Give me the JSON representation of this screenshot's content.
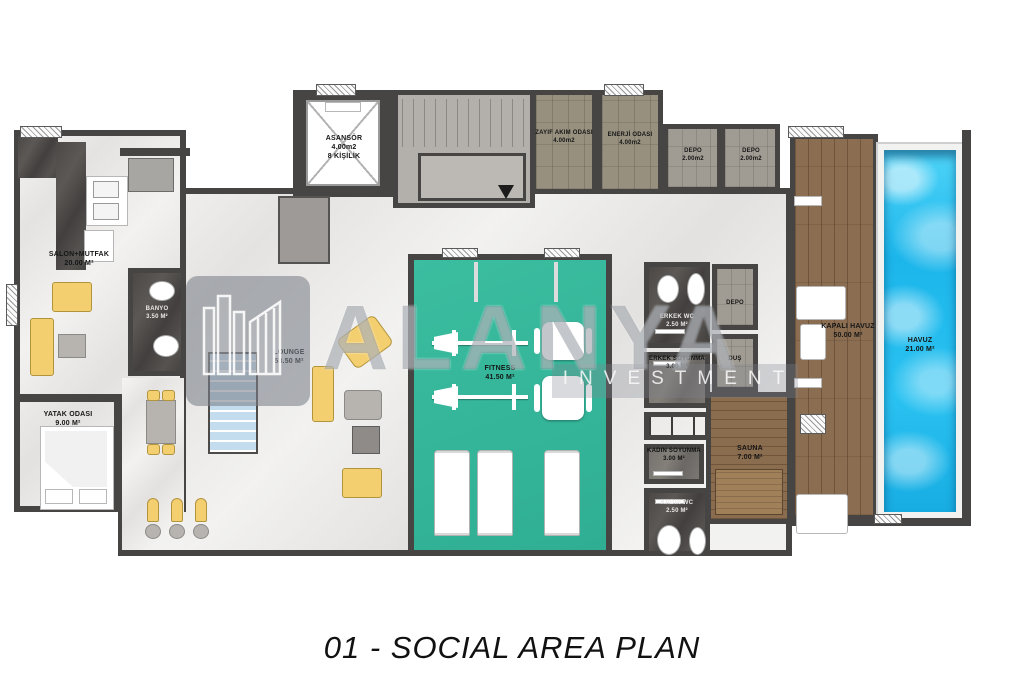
{
  "title": "01 - SOCIAL AREA PLAN",
  "watermark": {
    "brand": "ALANYA",
    "brand_sub": "INVESTMENT"
  },
  "colors": {
    "wall": "#474544",
    "floor_marble": "#e8e7e5",
    "fitness_teal": "#36b79b",
    "pool_blue": "#2ac2f1",
    "deck_wood": "#8b6e52",
    "furniture_yellow": "#f3cf70"
  },
  "rooms": {
    "salon_mutfak": {
      "name": "SALON+MUTFAK",
      "area": "20.00 M²"
    },
    "banyo": {
      "name": "BANYO",
      "area": "3.50 M²"
    },
    "yatak_odasi": {
      "name": "YATAK ODASI",
      "area": "9.00 M²"
    },
    "asansor": {
      "name": "ASANSÖR",
      "area": "4.00m2",
      "capacity": "8 KİŞİLİK"
    },
    "zayif_akim": {
      "name": "ZAYIF AKIM ODASI",
      "area": "4.00m2"
    },
    "enerji": {
      "name": "ENERJİ ODASI",
      "area": "4.00m2"
    },
    "depo_1": {
      "name": "DEPO",
      "area": "2.00m2"
    },
    "depo_2": {
      "name": "DEPO",
      "area": "2.00m2"
    },
    "lounge": {
      "name": "LOUNGE",
      "area": "58.50 M²"
    },
    "fitness": {
      "name": "FITNESS",
      "area": "41.50 M²"
    },
    "erkek_wc": {
      "name": "ERKEK WC",
      "area": "2.50 M²"
    },
    "erkek_soyunma": {
      "name": "ERKEK SOYUNMA",
      "area": "3.00 M²"
    },
    "depo_kucuk": {
      "name": "DEPO"
    },
    "dus": {
      "name": "DUŞ"
    },
    "kadin_soyunma": {
      "name": "KADIN SOYUNMA",
      "area": "3.00 M²"
    },
    "kadin_wc": {
      "name": "KADIN WC",
      "area": "2.50 M²"
    },
    "sauna": {
      "name": "SAUNA",
      "area": "7.00 M²"
    },
    "kapali_havuz": {
      "name": "KAPALI HAVUZ",
      "area": "50.00 M²"
    },
    "havuz": {
      "name": "HAVUZ",
      "area": "21.00 M²"
    }
  }
}
